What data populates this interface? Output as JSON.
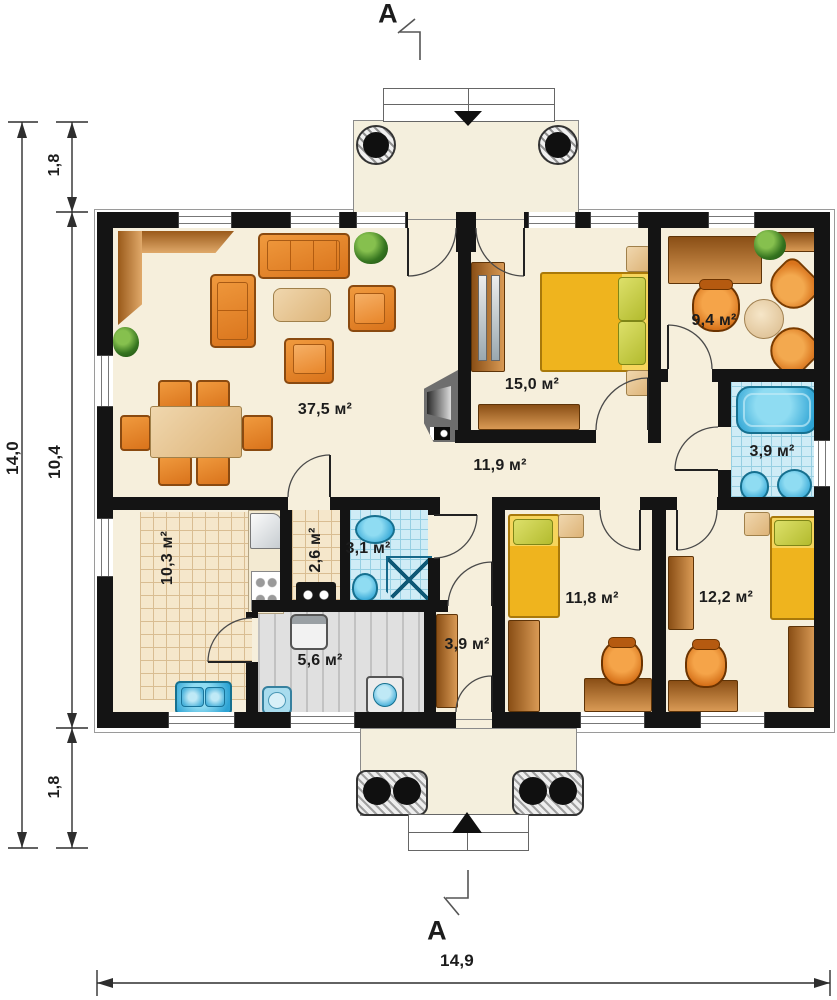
{
  "section": {
    "top": "A",
    "bottom": "A"
  },
  "dimensions": {
    "left_total": "14,0",
    "left_segments": [
      "1,8",
      "10,4",
      "1,8"
    ],
    "bottom_total": "14,9"
  },
  "rooms": {
    "living": "37,5 м²",
    "bedroom_main": "15,0 м²",
    "study": "9,4 м²",
    "bathroom_main": "3,9 м²",
    "hallway": "11,9 м²",
    "kitchen": "10,3 м²",
    "pantry": "2,6 м²",
    "bathroom_small": "3,1 м²",
    "utility": "5,6 м²",
    "entry_hall": "3,9 м²",
    "bedroom_two": "11,8 м²",
    "bedroom_three": "12,2 м²"
  },
  "colors": {
    "wall": "#141414",
    "floor": "#f6efdc",
    "furniture_orange": "#e8882f",
    "wood_brown": "#b06a28",
    "bed_yellow": "#f2c028",
    "water_blue": "#35aede",
    "tile_blue": "#cfecf6",
    "tile_beige": "#f5e7cb"
  }
}
